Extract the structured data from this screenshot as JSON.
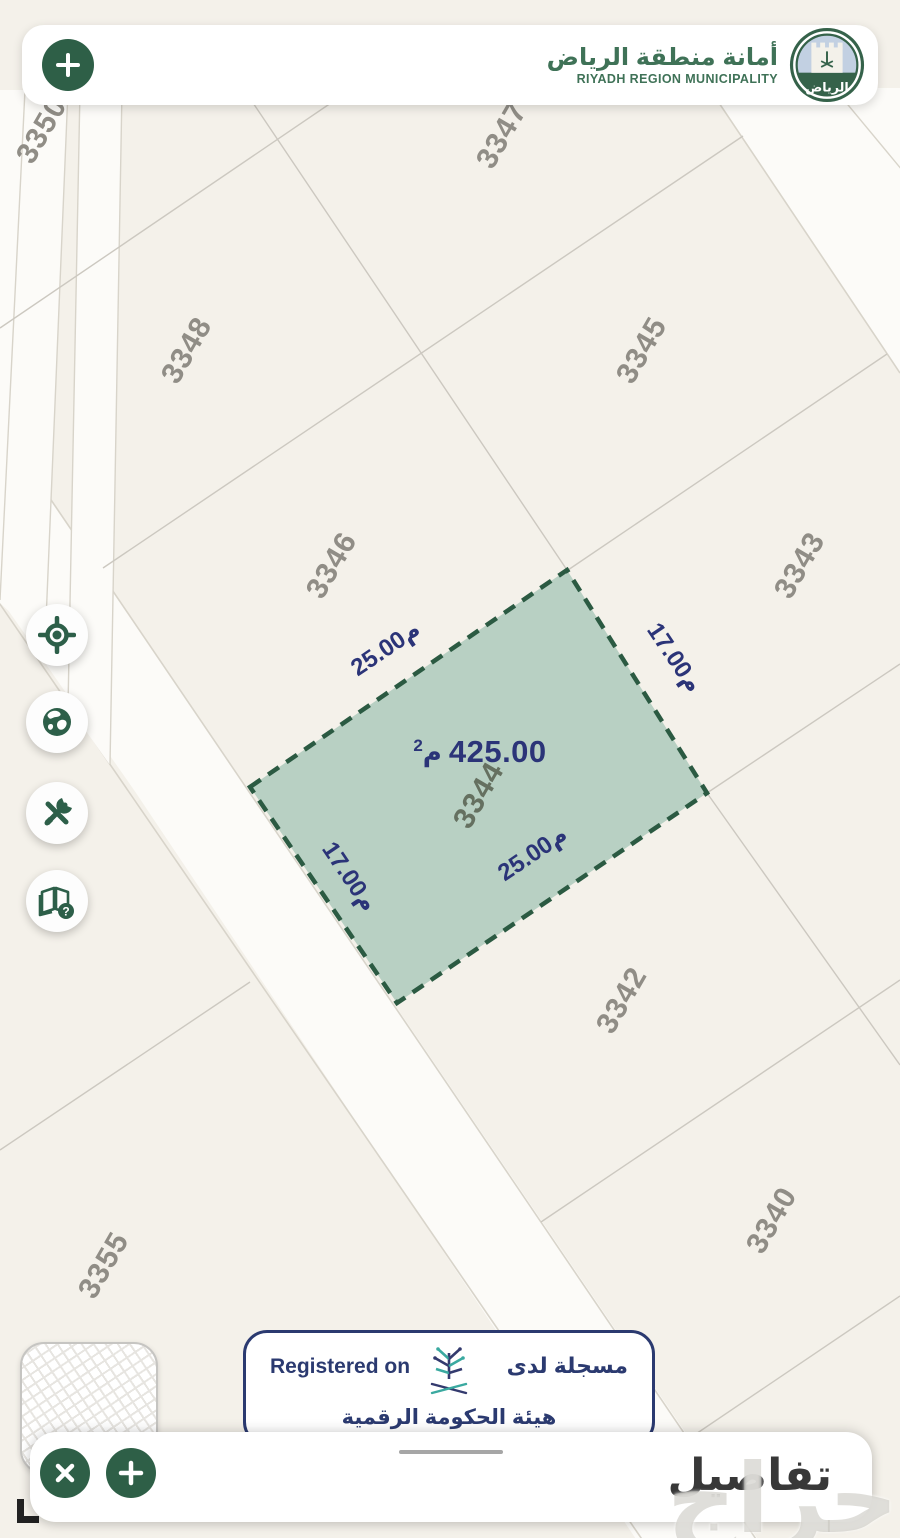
{
  "header": {
    "title_ar": "أمانة منطقة الرياض",
    "title_en": "RIYADH REGION MUNICIPALITY",
    "logo_script": "الرياض"
  },
  "map": {
    "parcels": [
      {
        "label": "3350"
      },
      {
        "label": "3347"
      },
      {
        "label": "3348"
      },
      {
        "label": "3345"
      },
      {
        "label": "3346"
      },
      {
        "label": "3343"
      },
      {
        "label": "3342"
      },
      {
        "label": "3340"
      },
      {
        "label": "3355"
      }
    ],
    "selected": {
      "number": "3344",
      "area_value": "425.00",
      "area_unit": "م",
      "area_sup": "2",
      "dim_top": "م25.00",
      "dim_right": "م17.00",
      "dim_bottom": "م25.00",
      "dim_left": "م17.00"
    }
  },
  "side_buttons": {
    "icons": [
      "locate-icon",
      "globe-icon",
      "tools-icon",
      "help-book-icon"
    ]
  },
  "registered_card": {
    "en": "Registered on",
    "ar": "مسجلة لدى",
    "authority": "هيئة الحكومة الرقمية"
  },
  "bottom_bar": {
    "details": "تفاصيل"
  },
  "watermark": "حراج",
  "colors": {
    "brand_green": "#2e5f47",
    "navy": "#2b3a74",
    "dimension_text": "#2b3478",
    "parcel_fill": "#b8d0c3",
    "parcel_stroke": "#2b5a42",
    "map_background": "#f4f1ea",
    "road_fill": "#fcfbf8"
  }
}
